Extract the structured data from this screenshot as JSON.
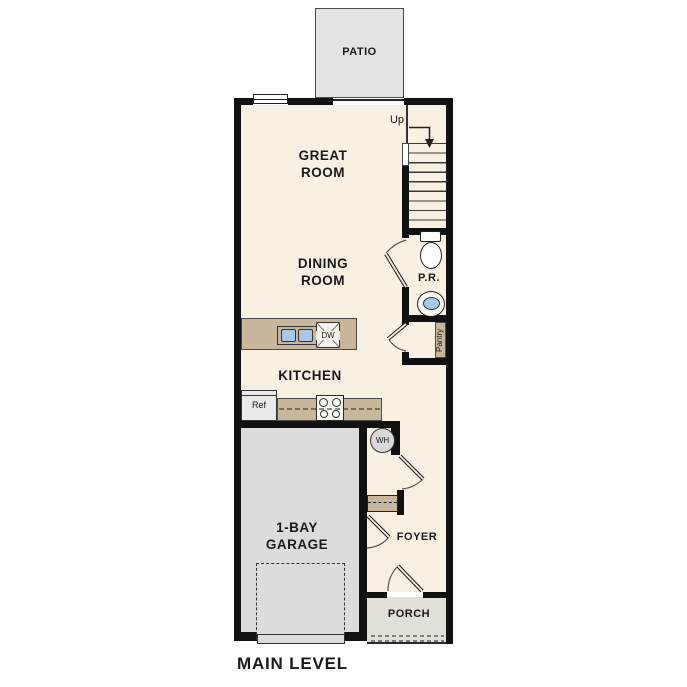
{
  "plan": {
    "title": "MAIN LEVEL",
    "rooms": {
      "patio": "PATIO",
      "great_room": [
        "GREAT",
        "ROOM"
      ],
      "dining_room": [
        "DINING",
        "ROOM"
      ],
      "kitchen": "KITCHEN",
      "garage": [
        "1-BAY",
        "GARAGE"
      ],
      "foyer": "FOYER",
      "porch": "PORCH",
      "powder_room": "P.R.",
      "pantry": "Pantry"
    },
    "annotations": {
      "stairs_up": "Up"
    },
    "appliances": {
      "refrigerator": "Ref",
      "dishwasher": "DW",
      "water_heater": "WH"
    },
    "colors": {
      "wall": "#111111",
      "floor": "#f7f0e3",
      "patio": "#e3e3e3",
      "garage": "#dcdcdc",
      "porch": "#e2dfd9",
      "casework_tan": "#c9b79d",
      "sink_blue": "#a9c7e6",
      "label_text": "#1a1a1a"
    }
  }
}
